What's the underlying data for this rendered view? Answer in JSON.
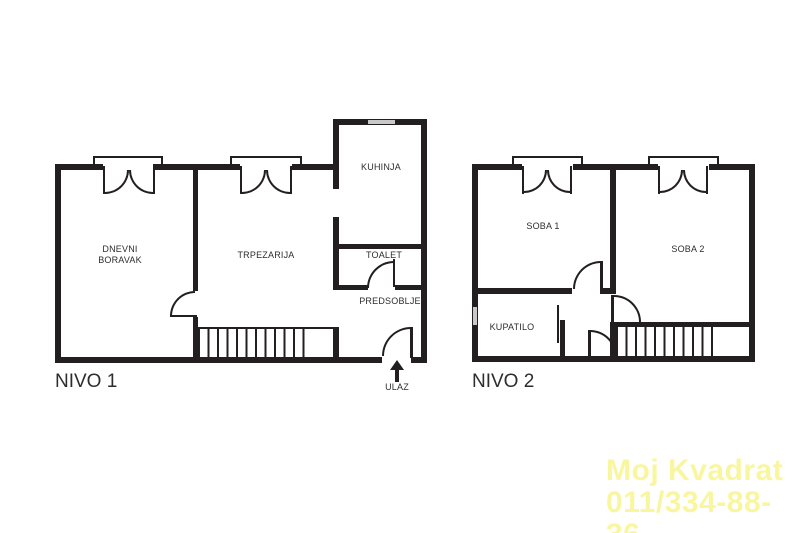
{
  "colors": {
    "wall": "#231f20",
    "label_text": "#2d2d2d",
    "window_glass": "#c9c9c9",
    "watermark": "#f9f6a0",
    "background": "#ffffff"
  },
  "level1": {
    "title": "NIVO 1",
    "rooms": {
      "living_line1": "DNEVNI",
      "living_line2": "BORAVAK",
      "dining": "TRPEZARIJA",
      "kitchen": "KUHINJA",
      "toilet": "TOALET",
      "hallway": "PREDSOBLJE"
    },
    "entrance_label": "ULAZ"
  },
  "level2": {
    "title": "NIVO 2",
    "rooms": {
      "room1": "SOBA 1",
      "room2": "SOBA 2",
      "bathroom": "KUPATILO"
    }
  },
  "watermark": {
    "company": "Moj Kvadrat",
    "phone": "011/334-88-36"
  }
}
